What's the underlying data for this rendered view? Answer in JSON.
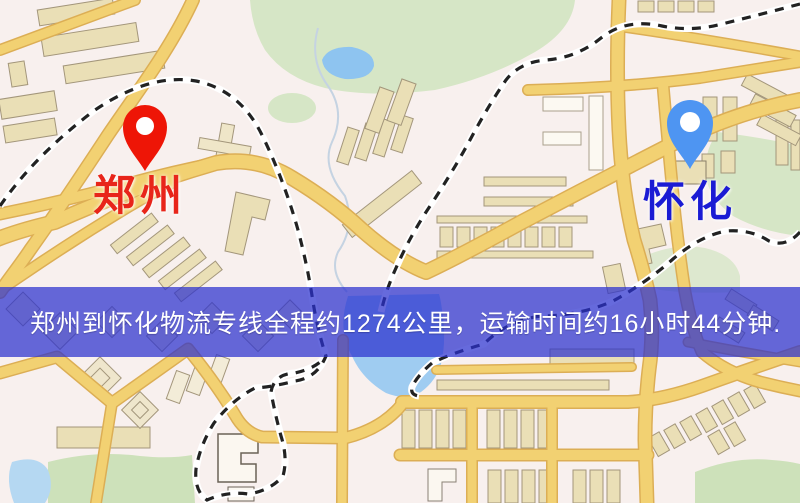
{
  "banner": {
    "text": "郑州到怀化物流专线全程约1274公里，运输时间约16小时44分钟.",
    "background_css": "rgba(43,48,207,0.72)",
    "background_color": "#2b30cf",
    "text_color": "#ffffff"
  },
  "markers": {
    "origin": {
      "label": "郑州",
      "pin_color": "#ee1506",
      "pin_inner_color": "#ffffff",
      "label_color": "#e8251a"
    },
    "destination": {
      "label": "怀化",
      "pin_color": "#4e95f2",
      "pin_inner_color": "#ffffff",
      "label_color": "#1b1bd4"
    }
  },
  "route": {
    "origin_city": "郑州",
    "destination_city": "怀化",
    "distance_km": "1274",
    "transport_time": "16小时44分钟"
  },
  "map_palette": {
    "background": "#f8f0ee",
    "road_fill": "#f2d172",
    "road_casing": "#dcae55",
    "building_fill": "#eadfb6",
    "building_stroke": "#a3967b",
    "park_green": "#d6e6c6",
    "water_blue": "#9fccf1",
    "railway_dash": "#222222",
    "railway_casing": "#ffffff"
  }
}
